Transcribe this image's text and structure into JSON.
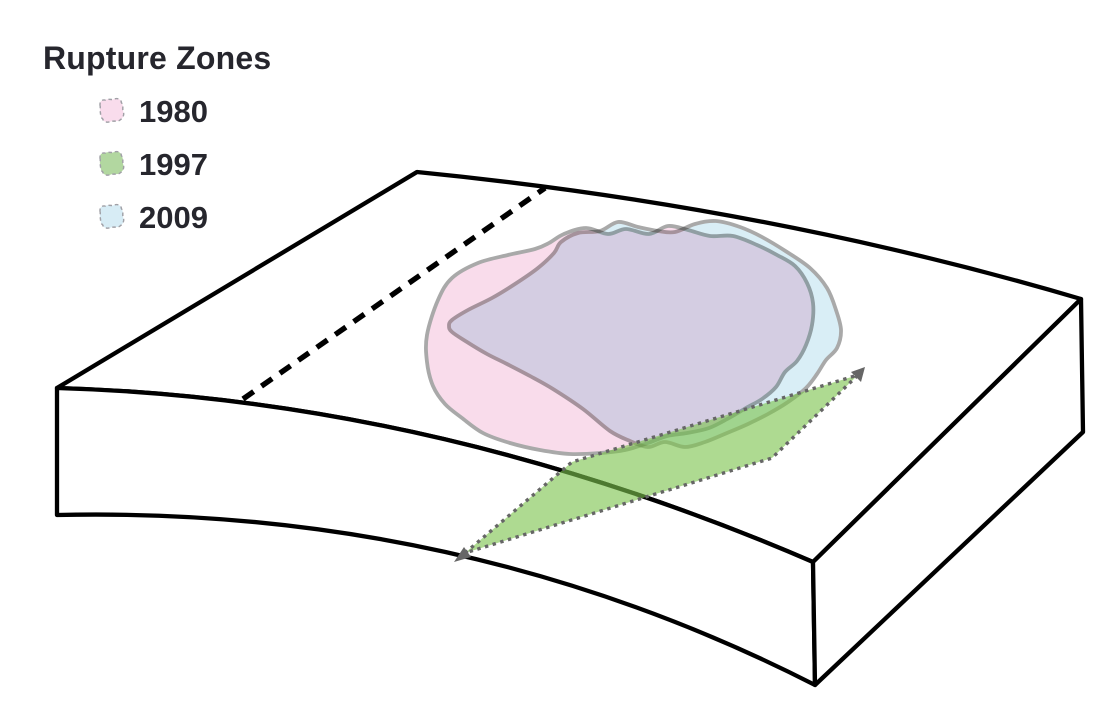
{
  "legend": {
    "title": "Rupture Zones",
    "items": [
      {
        "label": "1980",
        "swatch_color": "#f9dcec"
      },
      {
        "label": "1997",
        "swatch_color": "#b2d7a0"
      },
      {
        "label": "2009",
        "swatch_color": "#d7ecf5"
      }
    ]
  },
  "diagram": {
    "zone_1980_fill": "#f9dceb",
    "zone_2009_fill": "#d9eef6",
    "fault_plane_1997_fill": "#7cc34d",
    "blob_stroke": "#a9a9a9",
    "plane_dot_stroke": "#666666",
    "block_edge_color": "#000000",
    "swatch_dash_color": "#a0a0a6"
  }
}
